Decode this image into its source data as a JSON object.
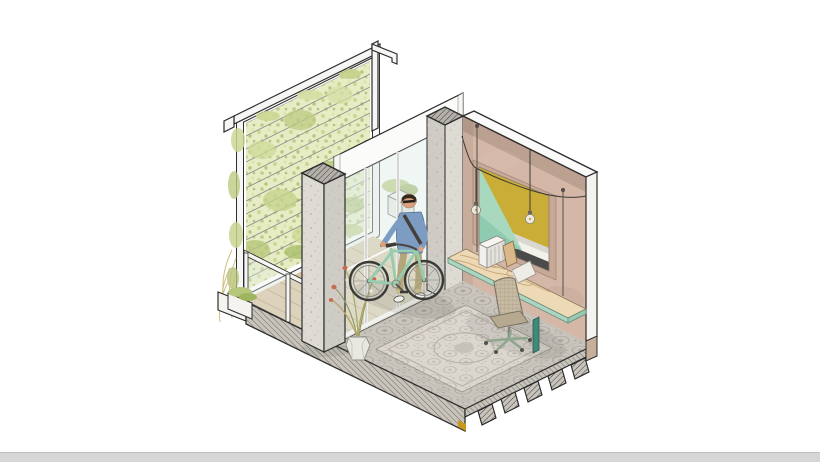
{
  "canvas": {
    "width": 820,
    "height": 462,
    "background": "#ffffff"
  },
  "scene": {
    "type": "isometric-architectural-cutaway",
    "objects": [
      "green-trellis-wall",
      "canopy-frame",
      "balcony-deck",
      "glass-balustrade",
      "sliding-glass-doors",
      "deck-planter-box",
      "concrete-column",
      "concrete-pilaster",
      "back-wall",
      "abstract-artwork",
      "string-lights",
      "pendant-bulb",
      "suspended-desk",
      "desk-radiator",
      "desk-satchel",
      "desk-book",
      "office-chair",
      "patterned-tile-floor",
      "area-rug",
      "floor-slab-edge",
      "ribbed-metal-deck",
      "potted-plant",
      "planter-box",
      "man-with-bicycle",
      "bicycle"
    ]
  },
  "palette": {
    "background": "#ffffff",
    "outline": "#2d2d2d",
    "wall_pink": "#d4b7a7",
    "wall_pink_recess": "#c8a998",
    "wall_top_white": "#fafaf8",
    "wall_end_white": "#f4f3f0",
    "concrete_light": "#dedbd4",
    "concrete_mid": "#cfccc5",
    "concrete_cap": "#b5b1aa",
    "green_wall_base": "#e7ecc4",
    "foliage_mid": "#c3d28b",
    "foliage_dark": "#9eb45e",
    "foliage_dry": "#cfbd82",
    "deck_wood": "#d9c4a5",
    "plank_line": "#b49a76",
    "door_frame_white": "#f6f6f4",
    "glass_tint": "rgba(223,238,234,0.5)",
    "tile_floor": "#c9c5bd",
    "tile_pattern": "#a49f96",
    "rug_base": "#dbd7cf",
    "rug_pattern": "#b5afa3",
    "slab_cut": "#c8c4bc",
    "footer_tan": "#c7b09a",
    "slab_mark_yellow": "#c8971f",
    "art_yellow": "#c9ad36",
    "art_mint": "#a8d8bd",
    "art_mint_shade": "#8fcbb0",
    "art_white": "#f2f1ec",
    "art_gray": "#d8d7d2",
    "art_charcoal": "#4b4b4b",
    "desk_wood": "#eed9b6",
    "desk_grain": "#c9a878",
    "desk_glass": "#aed4bf",
    "desk_leg_teal": "#3f8a78",
    "chair_mesh": "#c6baa2",
    "chair_seat": "#b7a98f",
    "chair_base": "#8ea68b",
    "bike_mint": "#97cdaf",
    "tire_dark": "#3a3a38",
    "shirt_blue": "#7d9cc4",
    "pants_khaki": "#b3a678",
    "skin": "#d9a181",
    "hair": "#33291f",
    "shoe_white": "#eeeeea",
    "strap_dark": "#45403a",
    "pot_white": "#e9e7e1",
    "flower_coral": "#c96a4f",
    "wire_dark": "#3e3a34",
    "bulb_glass": "#eceade",
    "bottom_bar": "#d6d6d6",
    "bottom_bar_line": "#bfbfbf"
  }
}
